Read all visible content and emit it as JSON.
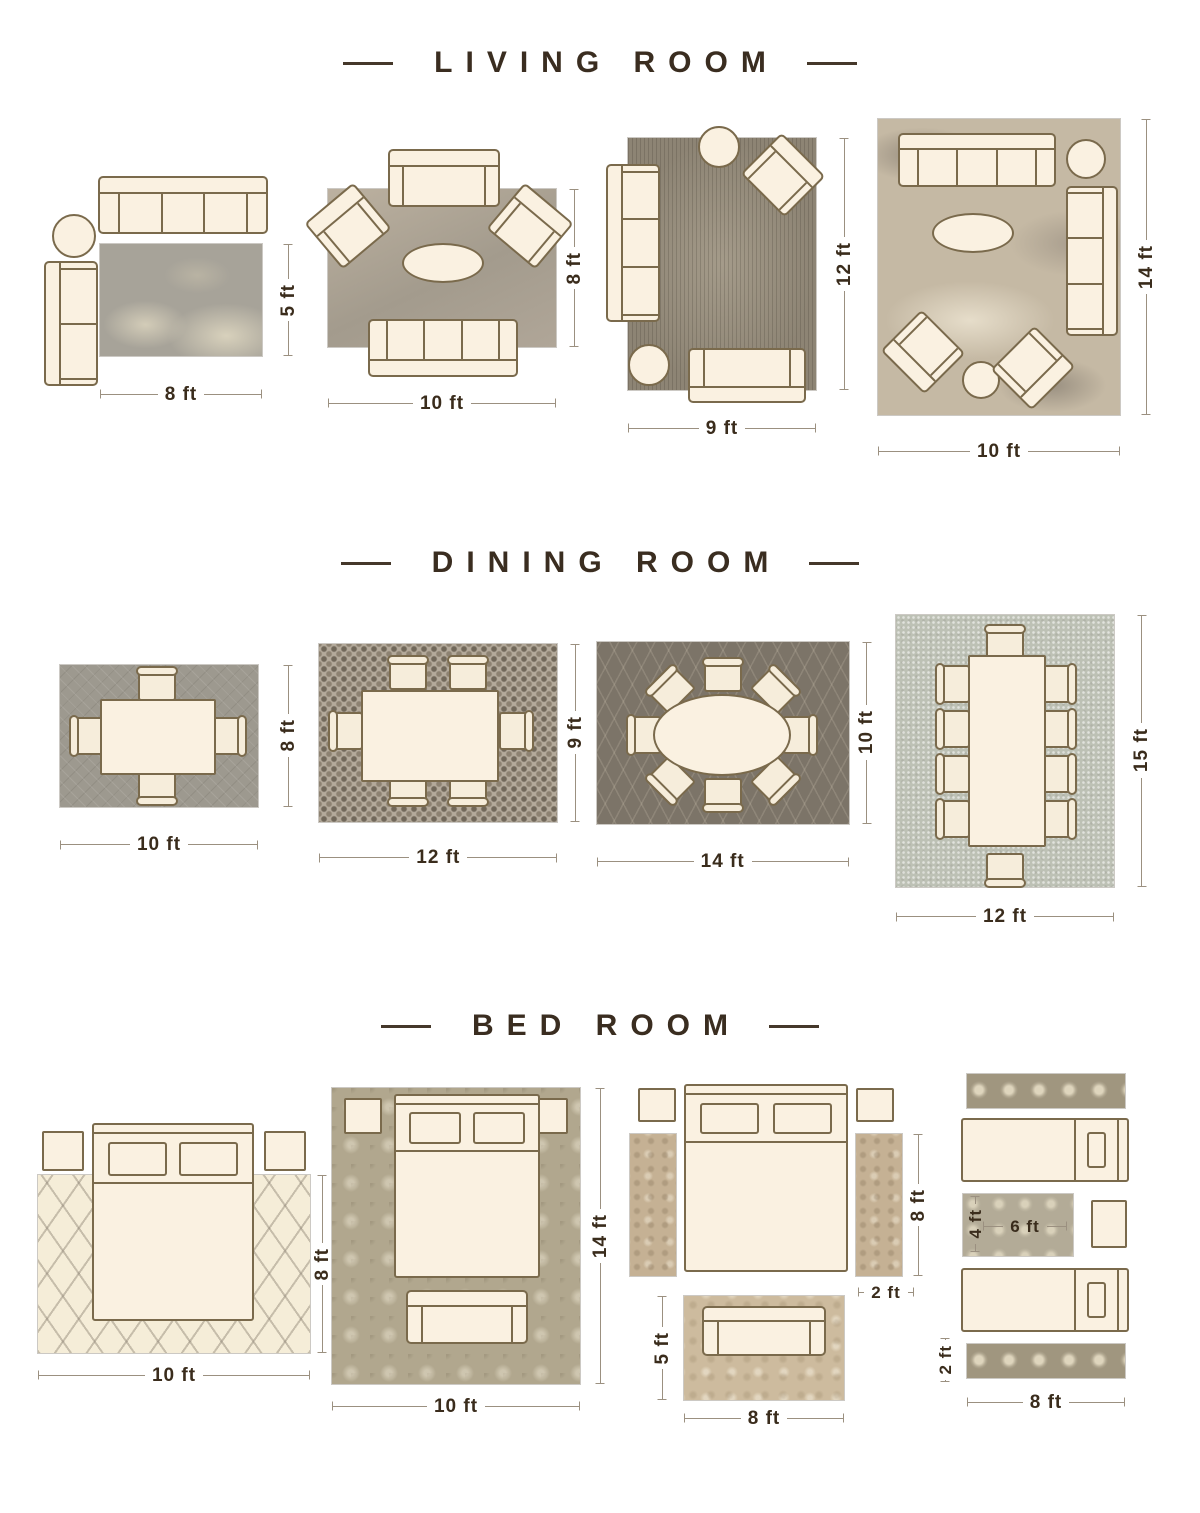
{
  "sections": [
    {
      "title": "LIVING ROOM",
      "layouts": [
        {
          "name": "living-room-8x5",
          "width": "8 ft",
          "height": "5 ft"
        },
        {
          "name": "living-room-10x8",
          "width": "10 ft",
          "height": "8 ft"
        },
        {
          "name": "living-room-9x12",
          "width": "9 ft",
          "height": "12 ft"
        },
        {
          "name": "living-room-10x14",
          "width": "10 ft",
          "height": "14 ft"
        }
      ]
    },
    {
      "title": "DINING ROOM",
      "layouts": [
        {
          "name": "dining-room-10x8",
          "width": "10 ft",
          "height": "8 ft"
        },
        {
          "name": "dining-room-12x9",
          "width": "12 ft",
          "height": "9 ft"
        },
        {
          "name": "dining-room-14x10",
          "width": "14 ft",
          "height": "10 ft"
        },
        {
          "name": "dining-room-12x15",
          "width": "12 ft",
          "height": "15 ft"
        }
      ]
    },
    {
      "title": "BED ROOM",
      "layouts": [
        {
          "name": "bed-room-10x8",
          "width": "10 ft",
          "height": "8 ft"
        },
        {
          "name": "bed-room-10x14",
          "width": "10 ft",
          "height": "14 ft"
        },
        {
          "name": "bed-room-runners",
          "runner_length": "8 ft",
          "runner_width": "2 ft",
          "front_width": "8 ft",
          "front_height": "5 ft"
        },
        {
          "name": "bed-room-twin",
          "accent_width": "6 ft",
          "accent_height": "4 ft",
          "runner_width": "2 ft",
          "bottom_width": "8 ft"
        }
      ]
    }
  ],
  "colors": {
    "background": "#ffffff",
    "title_text": "#3a2d20",
    "dimension_text": "#3a2c1c",
    "furniture_fill": "#faf1e1",
    "furniture_outline": "#7a6a4c",
    "living_rugs": [
      "#a7a399",
      "#aca290",
      "#8d8474",
      "#c5b9a4"
    ],
    "dining_rugs": [
      "#9d998f",
      "#b4aa9b",
      "#7c7468",
      "#bdc1b5"
    ],
    "bed_rugs": [
      "#f5edd8",
      "#b1a78e",
      "#c5b194",
      "#a0967f"
    ]
  }
}
